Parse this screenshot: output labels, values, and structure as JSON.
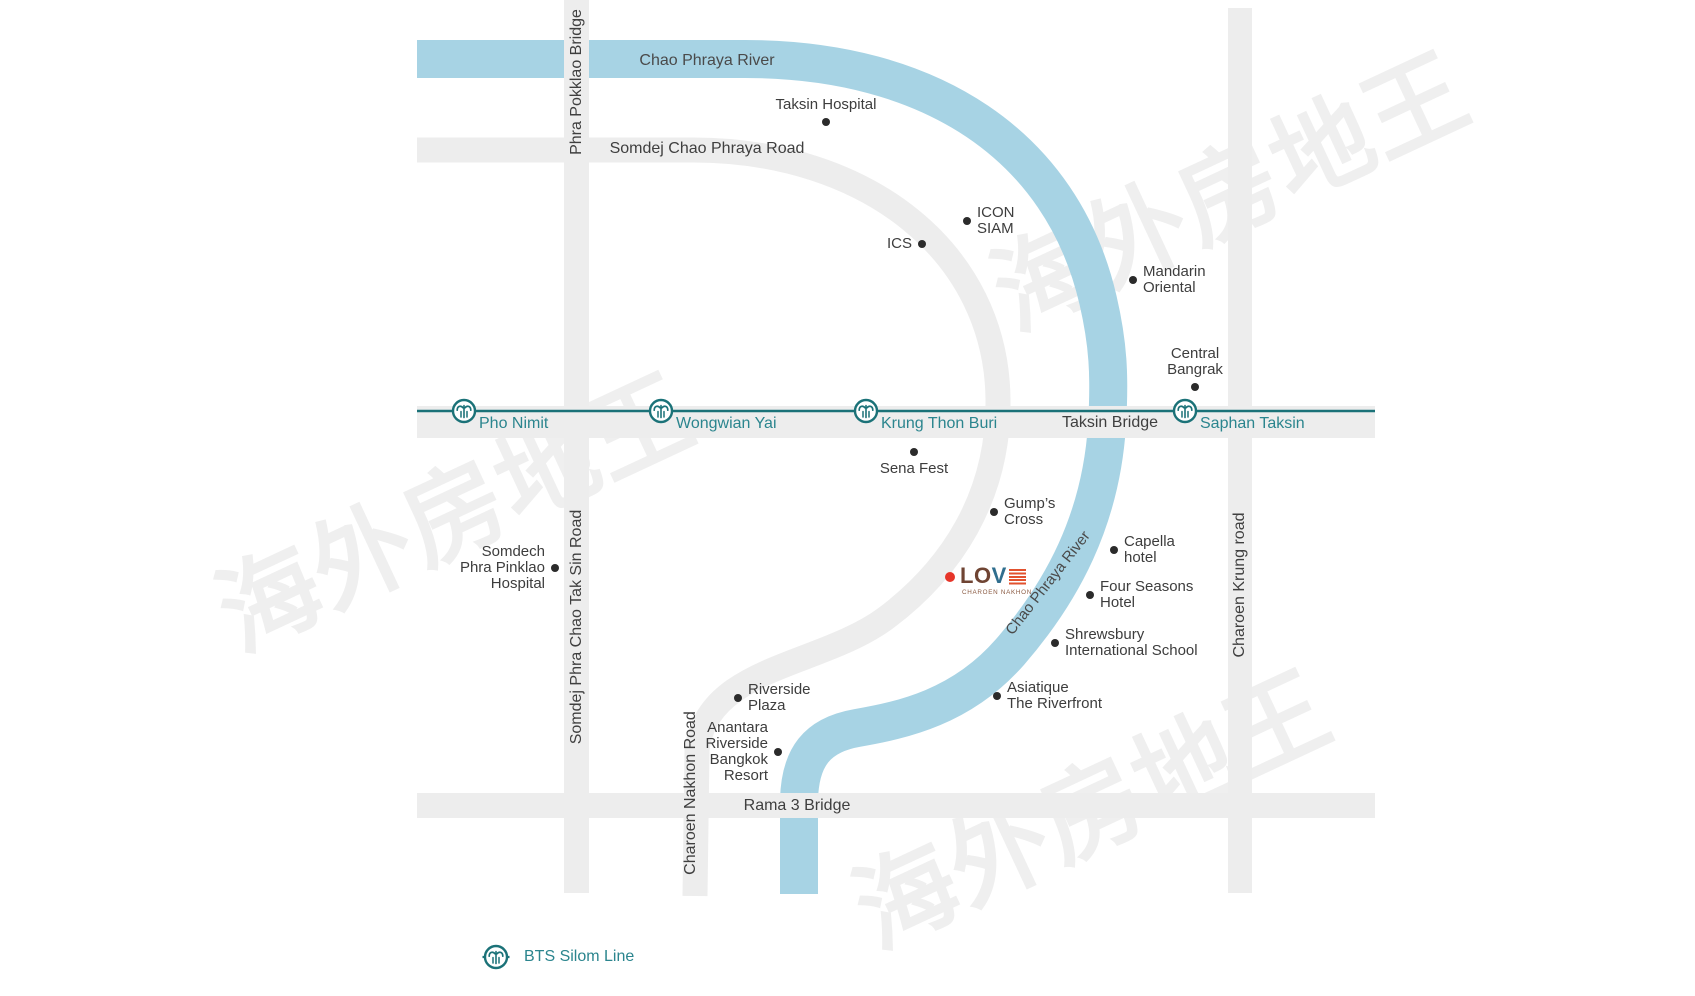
{
  "watermark": {
    "text": "海外房地王",
    "color": "#efefef"
  },
  "river": {
    "name": "Chao Phraya River",
    "color": "#a7d3e4",
    "label_top": "Chao Phraya River",
    "label_diagonal": "Chao Phraya River"
  },
  "roads": {
    "color": "#ededed",
    "label_color": "#3f3f3f",
    "phra_pokklao_bridge": "Phra Pokklao Bridge",
    "somdej_chao_phraya": "Somdej Chao Phraya Road",
    "somdej_phra_chao_tak_sin": "Somdej Phra Chao Tak Sin Road",
    "charoen_nakhon": "Charoen Nakhon Road",
    "charoen_krung": "Charoen Krung road",
    "taksin_bridge": "Taksin Bridge",
    "rama3_bridge": "Rama 3 Bridge"
  },
  "bts": {
    "line_color": "#1b7278",
    "label_color": "#2b858e",
    "line_y": 411,
    "stations": [
      {
        "name": "Pho Nimit",
        "x": 464
      },
      {
        "name": "Wongwian Yai",
        "x": 661
      },
      {
        "name": "Krung Thon Buri",
        "x": 866
      },
      {
        "name": "Saphan Taksin",
        "x": 1185
      }
    ]
  },
  "landmarks": {
    "dot_color": "#2b2b2b",
    "text_color": "#3d3d3d",
    "items": [
      {
        "id": "taksin-hospital",
        "lines": [
          "Taksin Hospital"
        ],
        "x": 826,
        "y": 122,
        "side": "above"
      },
      {
        "id": "icon-siam",
        "lines": [
          "ICON",
          "SIAM"
        ],
        "x": 967,
        "y": 221,
        "side": "right"
      },
      {
        "id": "ics",
        "lines": [
          "ICS"
        ],
        "x": 922,
        "y": 244,
        "side": "left"
      },
      {
        "id": "mandarin-oriental",
        "lines": [
          "Mandarin",
          "Oriental"
        ],
        "x": 1133,
        "y": 280,
        "side": "right"
      },
      {
        "id": "central-bangrak",
        "lines": [
          "Central",
          "Bangrak"
        ],
        "x": 1195,
        "y": 387,
        "side": "above"
      },
      {
        "id": "sena-fest",
        "lines": [
          "Sena Fest"
        ],
        "x": 914,
        "y": 452,
        "side": "below"
      },
      {
        "id": "gumps-cross",
        "lines": [
          "Gump’s",
          "Cross"
        ],
        "x": 994,
        "y": 512,
        "side": "right"
      },
      {
        "id": "capella-hotel",
        "lines": [
          "Capella",
          "hotel"
        ],
        "x": 1114,
        "y": 550,
        "side": "right"
      },
      {
        "id": "four-seasons-hotel",
        "lines": [
          "Four Seasons",
          "Hotel"
        ],
        "x": 1090,
        "y": 595,
        "side": "right"
      },
      {
        "id": "shrewsbury-school",
        "lines": [
          "Shrewsbury",
          "International School"
        ],
        "x": 1055,
        "y": 643,
        "side": "right"
      },
      {
        "id": "asiatique-riverfront",
        "lines": [
          "Asiatique",
          "The Riverfront"
        ],
        "x": 997,
        "y": 696,
        "side": "right"
      },
      {
        "id": "riverside-plaza",
        "lines": [
          "Riverside",
          "Plaza"
        ],
        "x": 738,
        "y": 698,
        "side": "right"
      },
      {
        "id": "anantara-resort",
        "lines": [
          "Anantara",
          "Riverside",
          "Bangkok",
          "Resort"
        ],
        "x": 778,
        "y": 752,
        "side": "left"
      },
      {
        "id": "somdech-pinklao-hospital",
        "lines": [
          "Somdech",
          "Phra Pinklao",
          "Hospital"
        ],
        "x": 555,
        "y": 568,
        "side": "left"
      }
    ]
  },
  "property": {
    "dot_color": "#e63529",
    "letters": [
      {
        "ch": "L",
        "color": "#6f4433"
      },
      {
        "ch": "O",
        "color": "#6f4433"
      },
      {
        "ch": "V",
        "color": "#2f6e8e"
      }
    ],
    "stripes_color": "#e2512e",
    "subtitle": "CHAROEN NAKHON",
    "subtitle_color": "#8a5a42"
  },
  "legend": {
    "label": "BTS Silom Line"
  }
}
